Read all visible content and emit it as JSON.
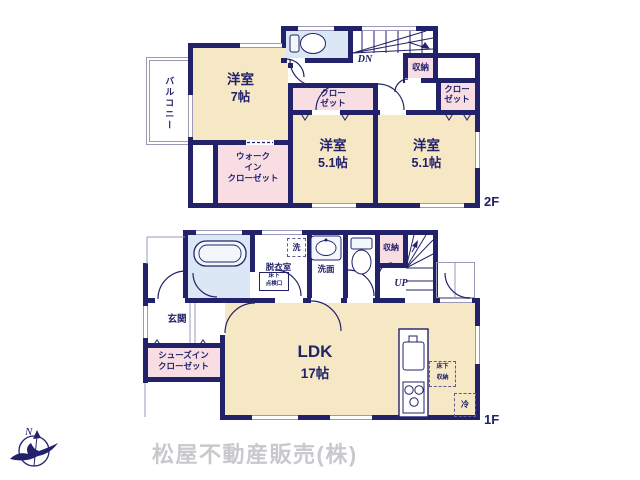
{
  "page": {
    "floor2_label": "2F",
    "floor1_label": "1F",
    "company_name": "松屋不動産販売(株)",
    "compass_north_label": "N"
  },
  "colors": {
    "wall_navy": "#22226b",
    "room_cream": "#f6e7c5",
    "closet_pink": "#f8dde3",
    "water_blue": "#dbe7f4",
    "company_gray": "#c8c8cd"
  },
  "floor2": {
    "balcony_label": "バルコニー",
    "bedroom7_name": "洋室",
    "bedroom7_size": "7帖",
    "bedroom51a_name": "洋室",
    "bedroom51a_size": "5.1帖",
    "bedroom51b_name": "洋室",
    "bedroom51b_size": "5.1帖",
    "closet_label": "クロー\nゼット",
    "walkin_closet_label": "ウォーク\nイン\nクローゼット",
    "storage_label": "収納",
    "stairs_down_label": "DN"
  },
  "floor1": {
    "entrance_label": "玄関",
    "shoes_closet_label": "シューズイン\nクローゼット",
    "dressing_room_label": "脱衣室",
    "laundry_label": "洗",
    "underfloor_hatch_label": "床下\n点検口",
    "washroom_label": "洗面",
    "storage_label": "収納",
    "stairs_up_label": "UP",
    "ldk_name": "LDK",
    "ldk_size": "17帖",
    "underfloor_storage_label": "床下\n収納",
    "refrigerator_label": "冷"
  }
}
